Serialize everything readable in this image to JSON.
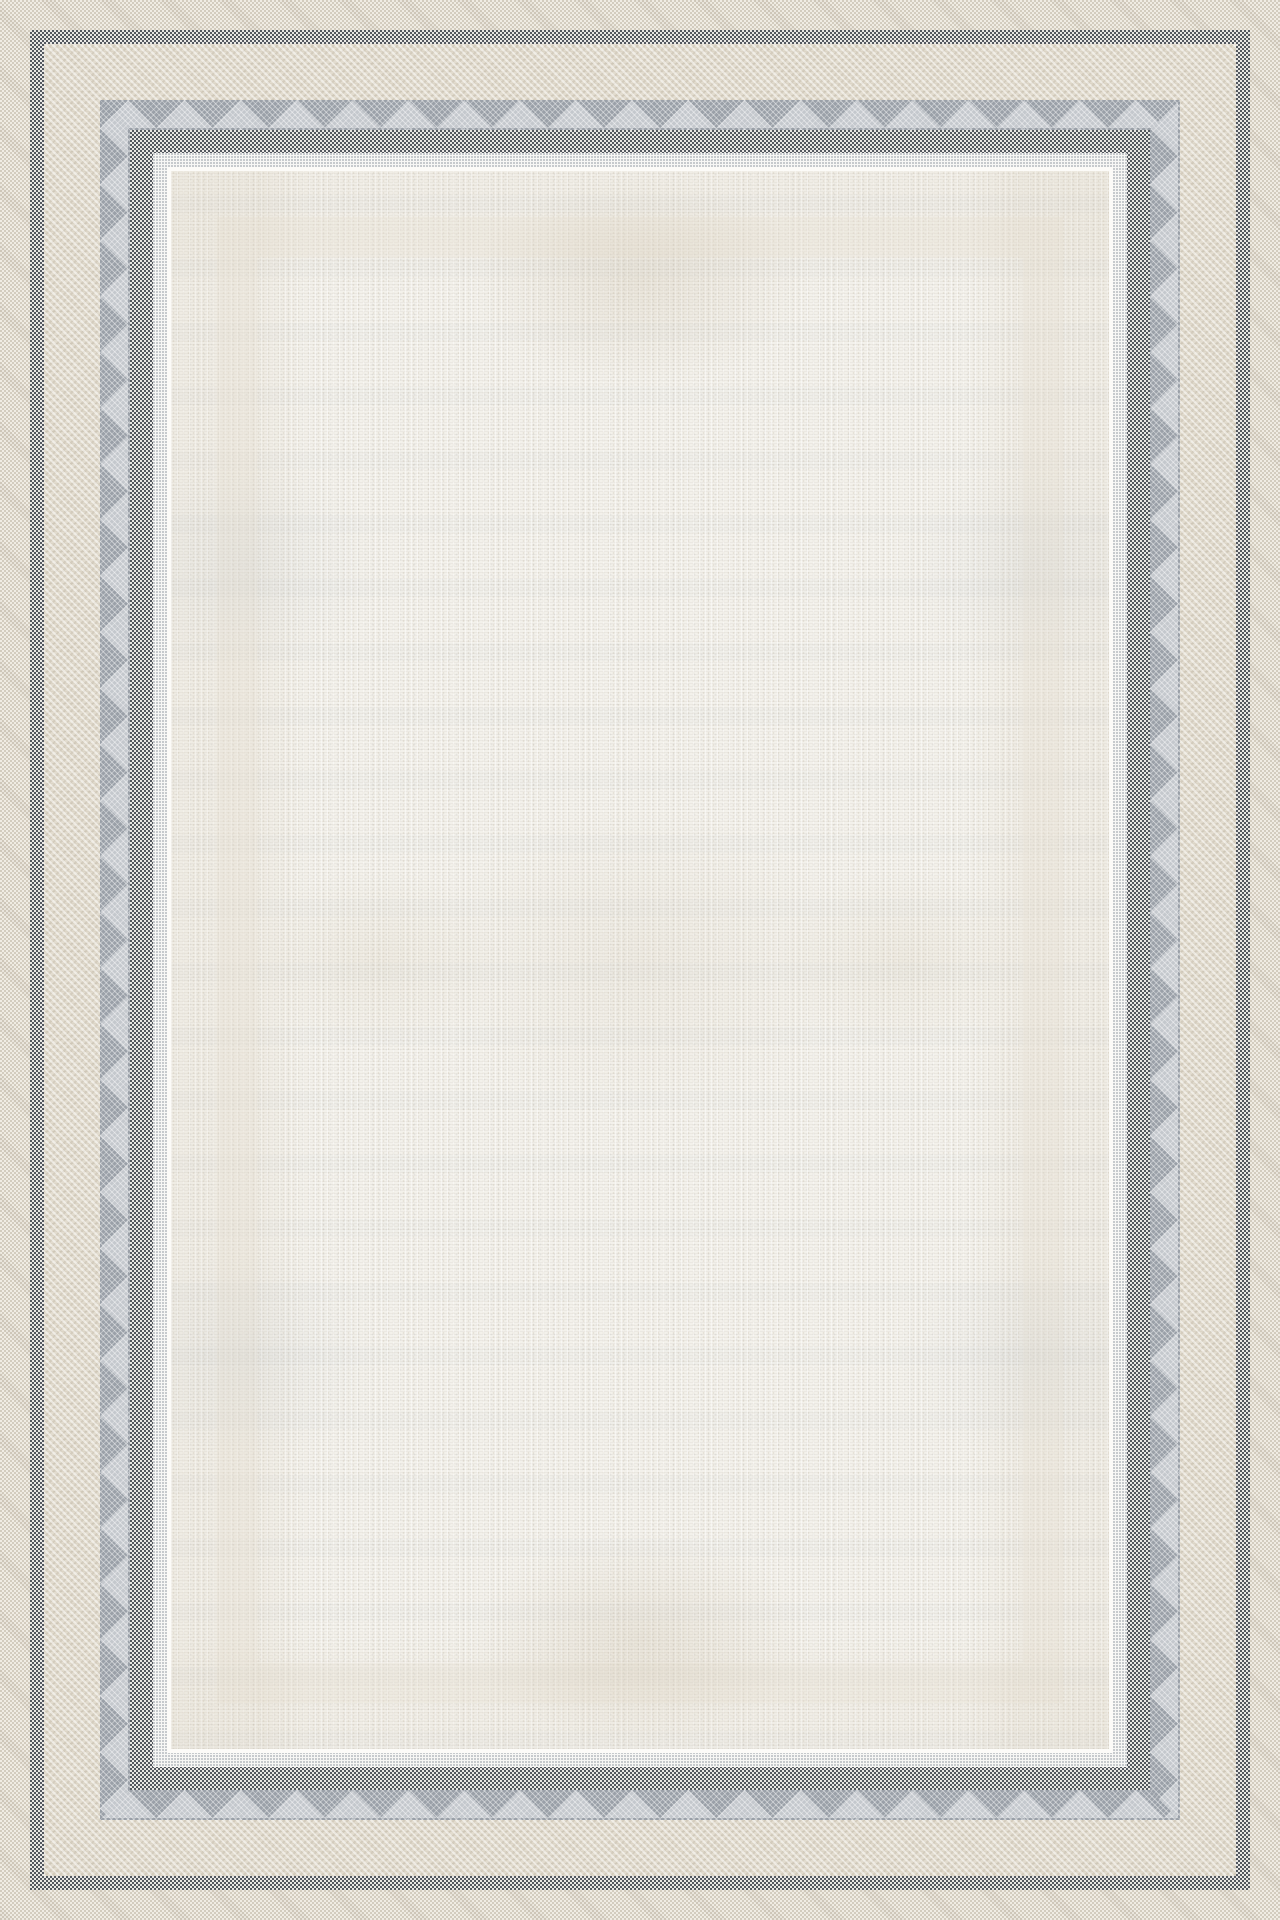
{
  "meta": {
    "content_type": "product-photograph",
    "subject": "rectangular flat-weave area rug",
    "description": "Cream-white textured rug field with faded beige geometric motifs, framed by concentric woven borders: tan selvedge, thin charcoal checker guard, wide cream herringbone band, grey chevron band, wide charcoal checker guard, and a white pin-dot transition into the field.",
    "orientation": "portrait"
  },
  "palette": {
    "outer-tan": "#d3ccbe",
    "weave-light": "#f0ece3",
    "dark-gray": "#53585f",
    "checker-light": "#e9e8e5",
    "cream-band": "#e2dccf",
    "gray-band-stripe": "#9aa0a8",
    "gray-band-mid": "#c4c8cd",
    "gray-band-light": "#e9eaea",
    "dot-gray": "#b9bdc2",
    "dotted-base": "#f7f7f5",
    "pinstripe": "#fcfbf8",
    "field": "#f3f1eb",
    "motif-tan": "#c3b494",
    "motif-blue": "#b0bac4"
  },
  "bands_outer_to_inner": [
    {
      "name": "outer-selvedge",
      "texture": "tan/white basket weave",
      "color": "#d3ccbe"
    },
    {
      "name": "outer-guard",
      "texture": "charcoal/white checker",
      "color": "#53585f"
    },
    {
      "name": "cream-band",
      "texture": "cream herringbone with faint chevrons",
      "color": "#e2dccf"
    },
    {
      "name": "grey-chevron-band",
      "texture": "grey zigzag herringbone",
      "color": "#9aa0a8"
    },
    {
      "name": "inner-guard",
      "texture": "charcoal/white checker",
      "color": "#53585f"
    },
    {
      "name": "dotted-band",
      "texture": "white with grey pin-dots",
      "color": "#b9bdc2"
    },
    {
      "name": "pinstripe",
      "texture": "plain pale line",
      "color": "#fcfbf8"
    },
    {
      "name": "field",
      "texture": "cream stipple with faded motifs",
      "color": "#f3f1eb"
    }
  ]
}
